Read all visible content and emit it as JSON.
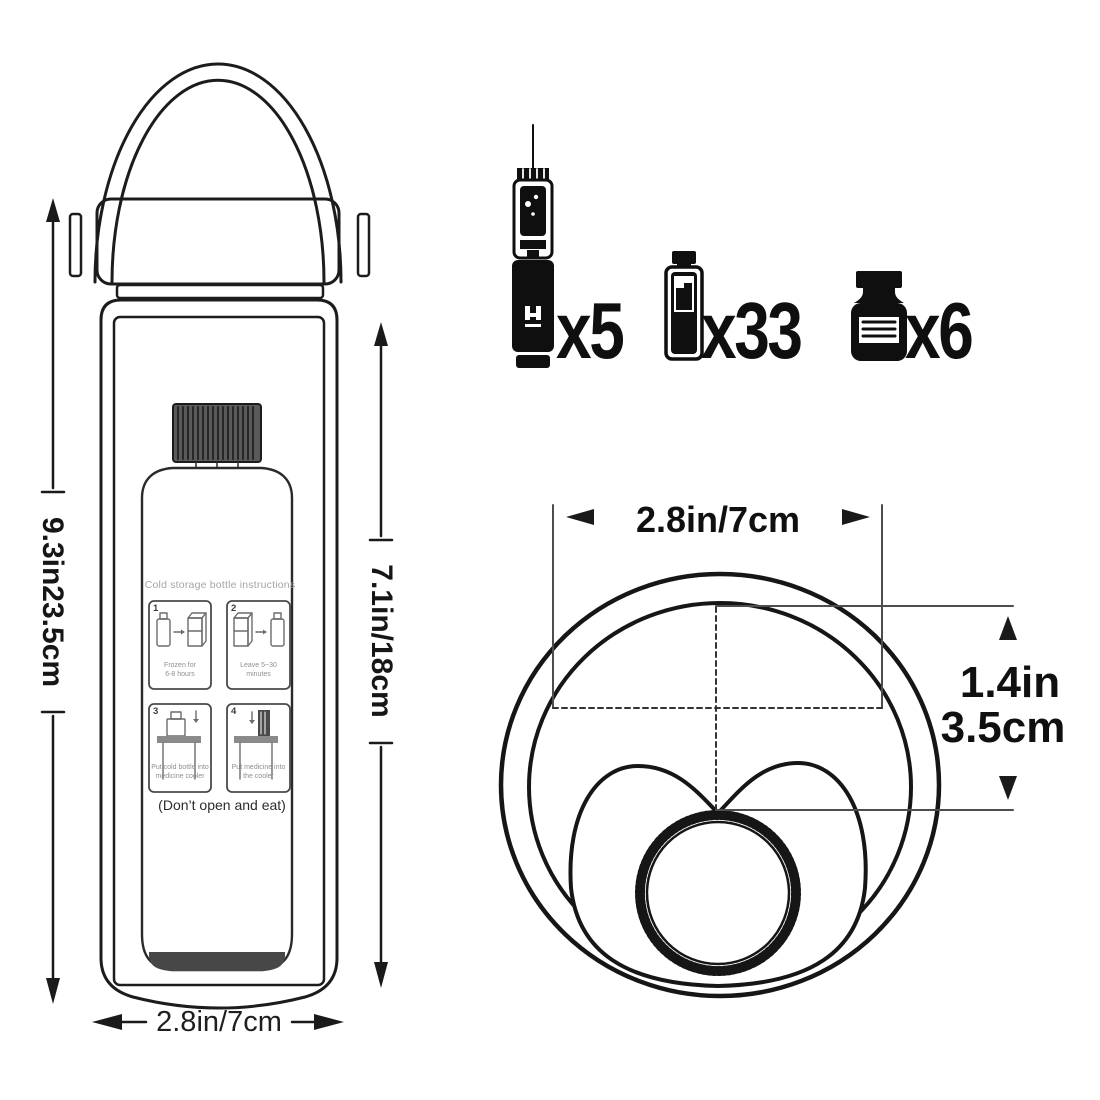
{
  "colors": {
    "ink": "#1c1c1c",
    "icon_black": "#0f0f0f",
    "extension_line": "#4d4d4d",
    "label_gray": "#a6a6a6",
    "caption_gray": "#8f8f8f"
  },
  "side_view": {
    "height_label": "9.3in23.5cm",
    "inner_height_label": "7.1in/18cm",
    "width_label": "2.8in/7cm",
    "bottle_label": {
      "title": "Cold storage bottle instructions",
      "steps": [
        {
          "num": "1",
          "line1": "Frozen for",
          "line2": "6-8 hours"
        },
        {
          "num": "2",
          "line1": "Leave 5~30",
          "line2": "minutes"
        },
        {
          "num": "3",
          "line1": "Put cold bottle into",
          "line2": "medicine cooler"
        },
        {
          "num": "4",
          "line1": "Put medicine into",
          "line2": "the cooler"
        }
      ],
      "warning": "(Don’t open and eat)"
    }
  },
  "capacity": {
    "items": [
      {
        "icon": "insulin-pen-icon",
        "count": "x5"
      },
      {
        "icon": "cartridge-icon",
        "count": "x33"
      },
      {
        "icon": "vial-icon",
        "count": "x6"
      }
    ]
  },
  "top_view": {
    "diameter_label": "2.8in/7cm",
    "depth_label_in": "1.4in",
    "depth_label_cm": "3.5cm"
  }
}
